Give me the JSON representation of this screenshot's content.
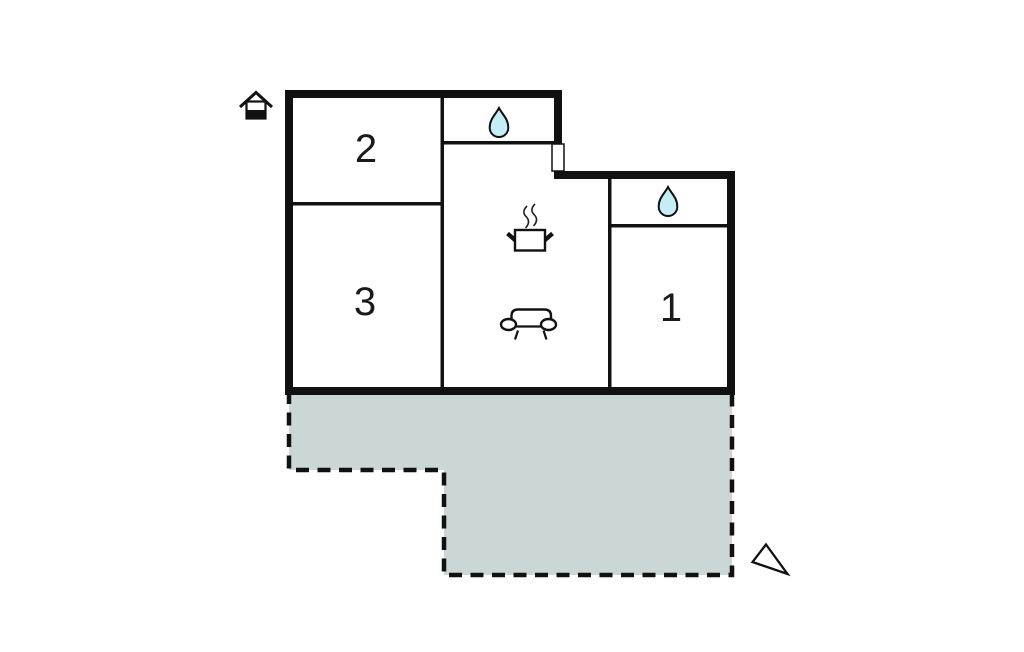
{
  "floorplan": {
    "rooms": [
      {
        "name": "room-1",
        "label": "1"
      },
      {
        "name": "room-2",
        "label": "2"
      },
      {
        "name": "room-3",
        "label": "3"
      }
    ],
    "icons": [
      "north-house-icon",
      "water-drop-icon-top-bathroom",
      "water-drop-icon-right-bathroom",
      "cooking-pot-icon",
      "sofa-icon",
      "view-direction-triangle-icon"
    ],
    "colors": {
      "wall": "#111111",
      "terrace_fill": "#cbd6d6",
      "water_drop_fill": "#c3eef5",
      "background": "#ffffff"
    }
  }
}
